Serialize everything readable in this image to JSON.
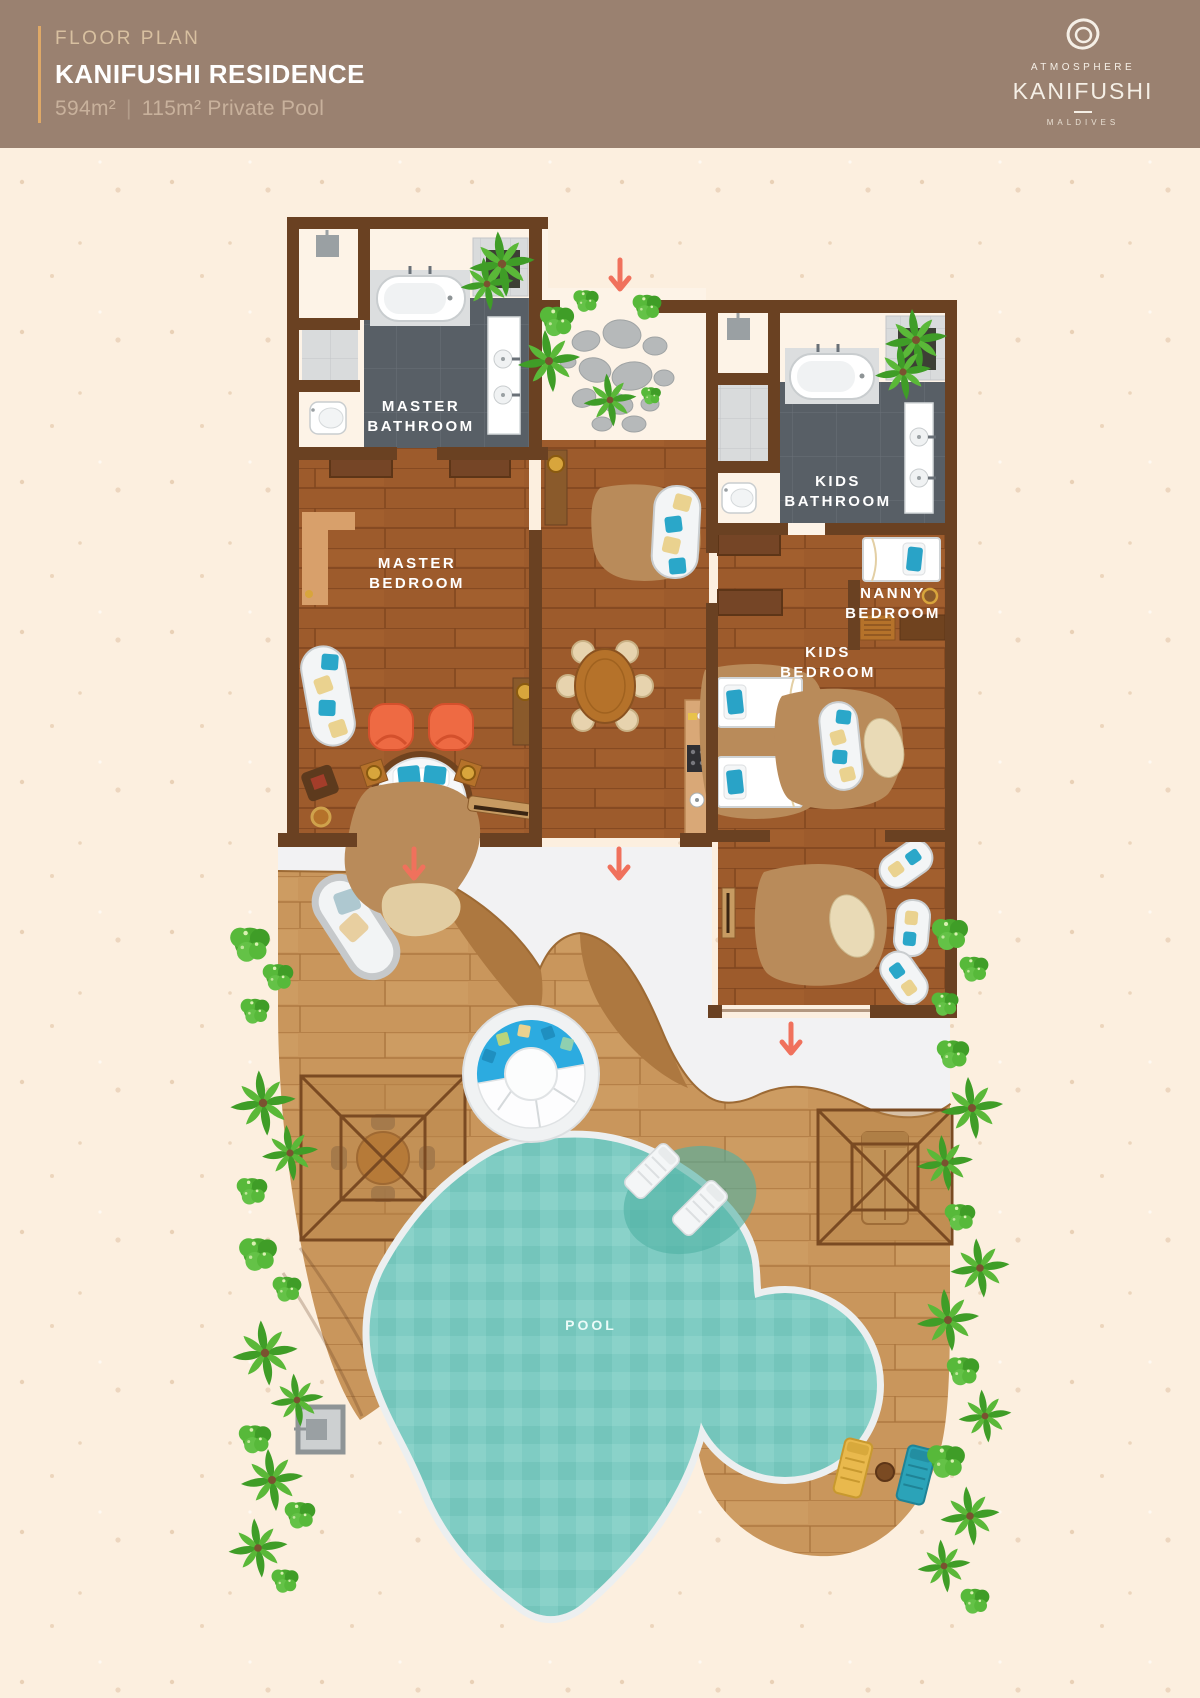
{
  "header": {
    "eyebrow": "FLOOR PLAN",
    "title": "KANIFUSHI RESIDENCE",
    "size": "594m²",
    "divider": "|",
    "pool_size": "115m² Private Pool"
  },
  "logo": {
    "brand": "ATMOSPHERE",
    "resort": "KANIFUSHI",
    "country": "MALDIVES"
  },
  "labels": {
    "master_bathroom": {
      "line1": "MASTER",
      "line2": "BATHROOM"
    },
    "master_bedroom": {
      "line1": "MASTER",
      "line2": "BEDROOM"
    },
    "kids_bathroom": {
      "line1": "KIDS",
      "line2": "BATHROOM"
    },
    "nanny_bedroom": {
      "line1": "NANNY",
      "line2": "BEDROOM"
    },
    "kids_bedroom": {
      "line1": "KIDS",
      "line2": "BEDROOM"
    },
    "pool": {
      "line1": "POOL"
    }
  },
  "palette": {
    "header_bg": "#9A8170",
    "accent_gold": "#DFA967",
    "background": "#FCEFDF",
    "wall_brown": "#6A4122",
    "interior_wood": "#9D5B2C",
    "deck_wood": "#C9965C",
    "pathway_white": "#F2F2F3",
    "pool_water": "#7FCCC3",
    "jacuzzi_blue": "#2CABE0",
    "arrow_coral": "#F0715C",
    "plant_green": "#57B93A",
    "bathroom_tile": "#585F66",
    "marble": "#DADCDD",
    "label_text": "#FFFFFF"
  }
}
